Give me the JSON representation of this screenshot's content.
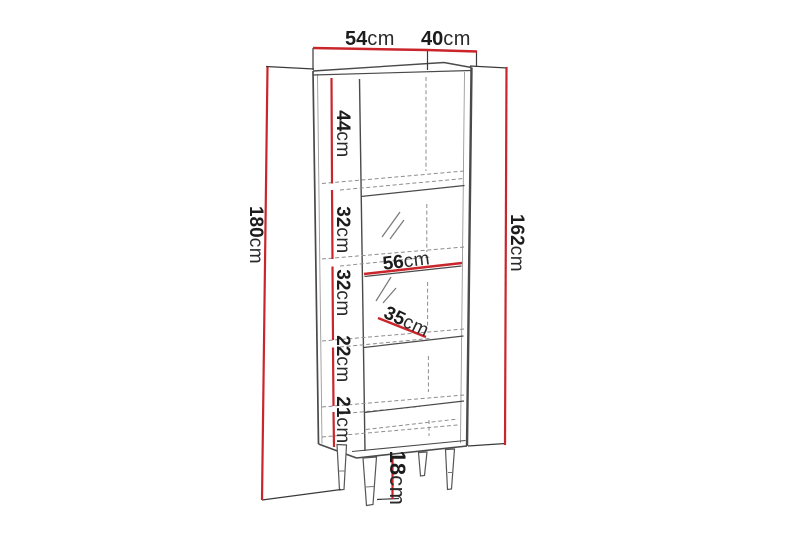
{
  "diagram": {
    "subject": "tall display cabinet dimension drawing",
    "background_color": "#ffffff",
    "accent_color": "#c9252b",
    "line_color": "#4a4a4a",
    "labels": {
      "top_width": {
        "num": "54",
        "unit": "cm"
      },
      "top_depth": {
        "num": "40",
        "unit": "cm"
      },
      "overall_height": {
        "num": "180",
        "unit": "cm"
      },
      "body_height": {
        "num": "162",
        "unit": "cm"
      },
      "leg_height": {
        "num": "18",
        "unit": "cm"
      },
      "inner_width": {
        "num": "56",
        "unit": "cm"
      },
      "inner_depth": {
        "num": "35",
        "unit": "cm"
      },
      "compartments": [
        {
          "num": "44",
          "unit": "cm"
        },
        {
          "num": "32",
          "unit": "cm"
        },
        {
          "num": "32",
          "unit": "cm"
        },
        {
          "num": "22",
          "unit": "cm"
        },
        {
          "num": "21",
          "unit": "cm"
        }
      ]
    }
  }
}
